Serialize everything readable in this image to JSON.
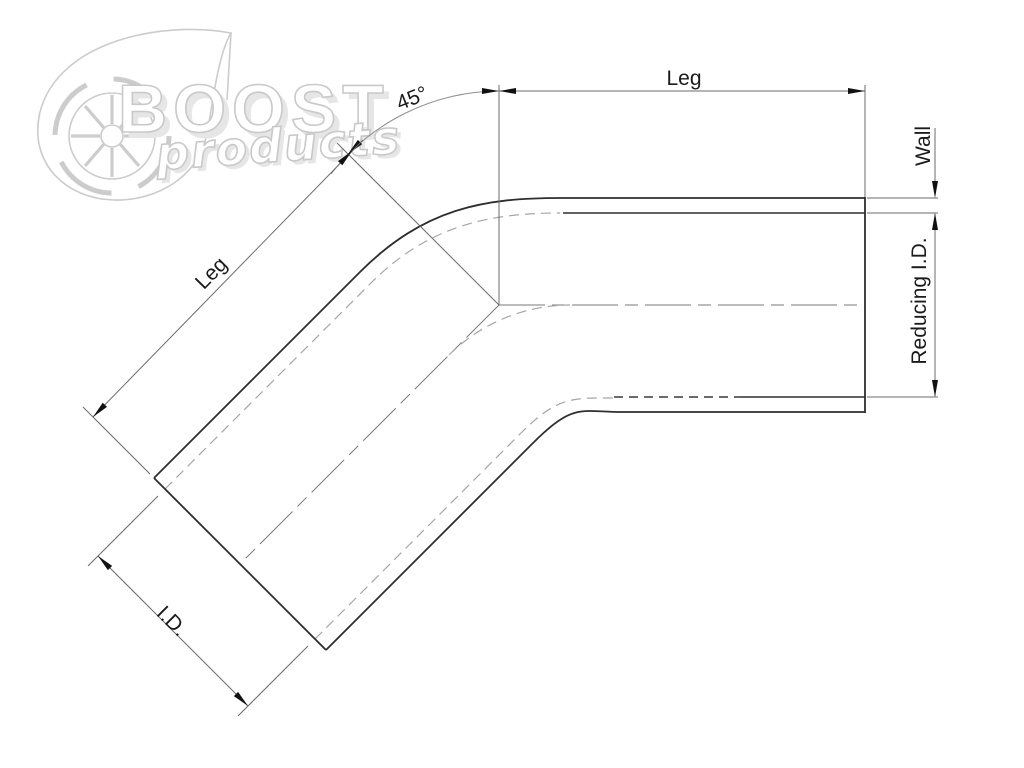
{
  "drawing": {
    "title": "45 degree reducing elbow dimension drawing",
    "labels": {
      "leg_top": "Leg",
      "leg_diagonal": "Leg",
      "wall": "Wall",
      "reducing_id": "Reducing I.D.",
      "angle": "45°",
      "inner_diameter": "I.D."
    }
  },
  "watermark": {
    "brand": "BOOST",
    "brand_sub": "products"
  },
  "colors": {
    "background": "#ffffff",
    "pipe_outline": "#2e2e2e",
    "dimension_lines": "#6b6b6b",
    "hidden_lines": "#a6a6a6",
    "label_text": "#1b1b1b",
    "watermark_gray": "#c9c9c9"
  }
}
